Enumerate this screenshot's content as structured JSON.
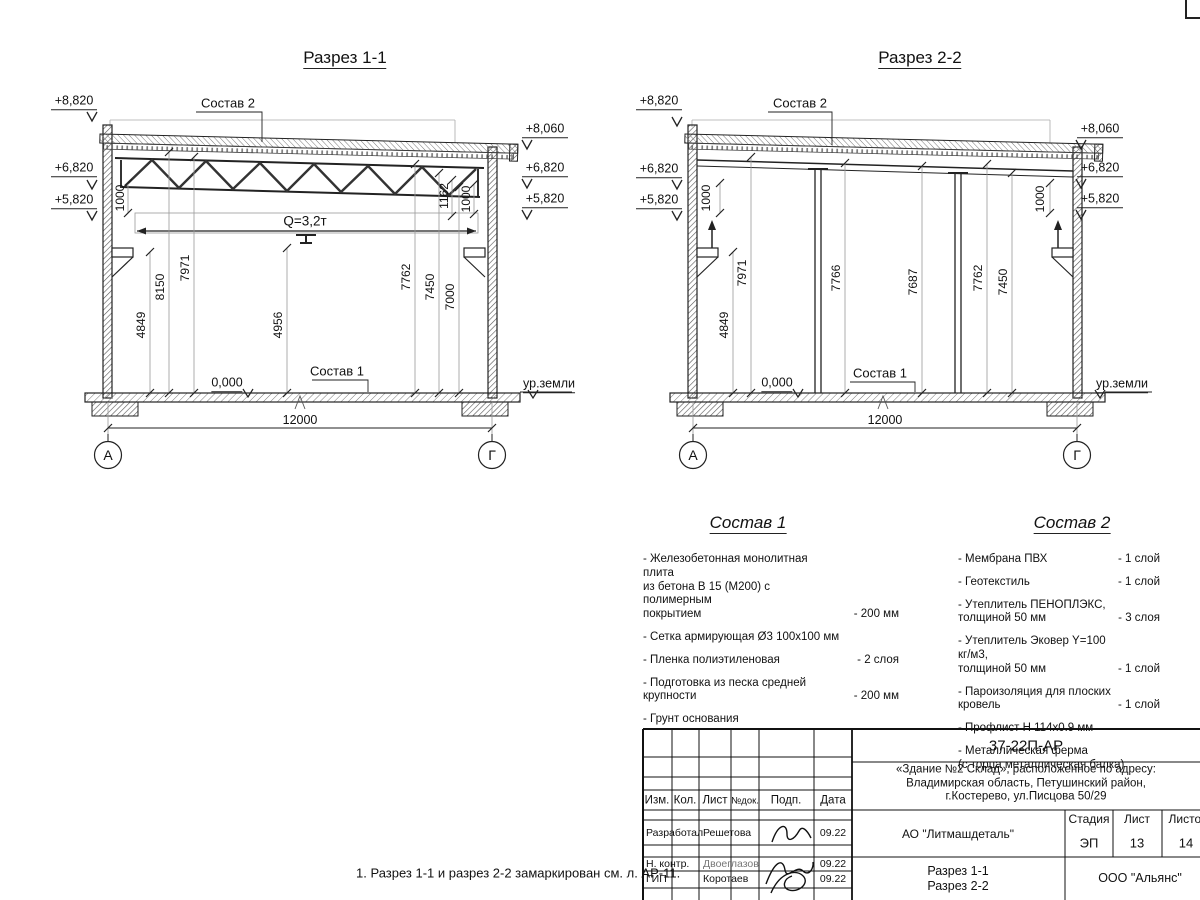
{
  "page": {
    "note": "1. Разрез 1-1 и разрез 2-2 замаркирован см. л. АР-11."
  },
  "section1": {
    "title": "Разрез 1-1",
    "sostav2_label": "Состав 2",
    "sostav1_label": "Состав 1",
    "crane_label": "Q=3,2т",
    "zero_label": "0,000",
    "ground_label": "ур.земли",
    "span_label": "12000",
    "axis_left": "А",
    "axis_right": "Г",
    "elev": {
      "l1": "+8,820",
      "l2": "+6,820",
      "l3": "+5,820",
      "r1": "+8,060",
      "r2": "+6,820",
      "r3": "+5,820"
    },
    "dims": {
      "d1000l": "1000",
      "d4849": "4849",
      "d8150": "8150",
      "d7971": "7971",
      "d4956": "4956",
      "d7762": "7762",
      "d7450": "7450",
      "d7000": "7000",
      "d1162": "1162",
      "d1000r": "1000"
    }
  },
  "section2": {
    "title": "Разрез 2-2",
    "sostav2_label": "Состав 2",
    "sostav1_label": "Состав 1",
    "zero_label": "0,000",
    "ground_label": "ур.земли",
    "span_label": "12000",
    "axis_left": "А",
    "axis_right": "Г",
    "elev": {
      "l1": "+8,820",
      "l2": "+6,820",
      "l3": "+5,820",
      "r1": "+8,060",
      "r2": "+6,820",
      "r3": "+5,820"
    },
    "dims": {
      "d1000l": "1000",
      "d4849": "4849",
      "d7971": "7971",
      "d7766": "7766",
      "d7687": "7687",
      "d7762": "7762",
      "d7450": "7450",
      "d1000r": "1000"
    }
  },
  "sostav1": {
    "title": "Состав 1",
    "items": [
      {
        "name": "- Железобетонная  монолитная плита\nиз бетона В 15 (М200) с полимерным\nпокрытием",
        "value": "- 200 мм"
      },
      {
        "name": "- Сетка армирующая Ø3 100х100 мм",
        "value": ""
      },
      {
        "name": "- Пленка полиэтиленовая",
        "value": "- 2 слоя"
      },
      {
        "name": "- Подготовка из песка средней\n  крупности",
        "value": "- 200 мм"
      },
      {
        "name": "- Грунт основания",
        "value": ""
      }
    ]
  },
  "sostav2": {
    "title": "Состав 2",
    "items": [
      {
        "name": "- Мембрана ПВХ",
        "value": "- 1 слой"
      },
      {
        "name": "- Геотекстиль",
        "value": "- 1 слой"
      },
      {
        "name": "- Утеплитель ПЕНОПЛЭКС,\n  толщиной 50 мм",
        "value": "- 3 слоя"
      },
      {
        "name": "- Утеплитель Эковер Y=100 кг/м3,\n  толщиной 50 мм",
        "value": "- 1 слой"
      },
      {
        "name": "- Пароизоляция для плоских кровель",
        "value": "- 1 слой"
      },
      {
        "name": "- Профлист Н 114х0.9 мм",
        "value": ""
      },
      {
        "name": "- Металлическая ферма\n  (с торца металлическая балка)",
        "value": ""
      }
    ]
  },
  "titleblock": {
    "doc_code": "37-22П-АР",
    "address_line1": "«Здание №2 Склад», расположенное по адресу:",
    "address_line2": "Владимирская область, Петушинский район,",
    "address_line3": "г.Костерево, ул.Писцова 50/29",
    "headers": {
      "izm": "Изм.",
      "kol": "Кол.",
      "list": "Лист",
      "ndok": "№док.",
      "podp": "Подп.",
      "data": "Дата"
    },
    "rows": [
      {
        "role": "Разработал",
        "name": "Решетова",
        "date": "09.22"
      },
      {
        "role": "Н. контр.",
        "name": "Двоеглазов",
        "date": "09.22"
      },
      {
        "role": "ГИП",
        "name": "Коротаев",
        "date": "09.22"
      }
    ],
    "org": "АО \"Литмашдеталь\"",
    "stage_label": "Стадия",
    "sheet_label": "Лист",
    "sheets_label": "Листов",
    "stage": "ЭП",
    "sheet": "13",
    "sheets": "14",
    "content_line1": "Разрез 1-1",
    "content_line2": "Разрез 2-2",
    "company": "ООО \"Альянс\""
  }
}
